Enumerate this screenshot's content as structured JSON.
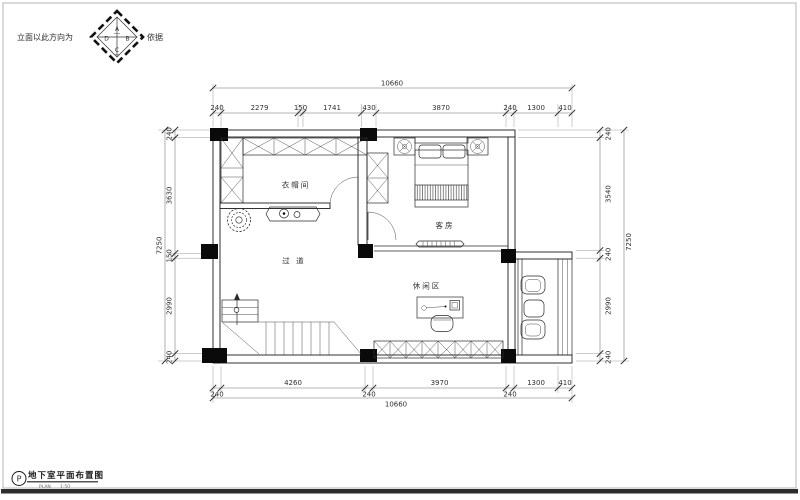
{
  "compass": {
    "left_label": "立面以此方向为",
    "right_label": "依据",
    "sector_top": "A",
    "sector_right": "B",
    "sector_bottom": "C",
    "sector_left": "D"
  },
  "title_block": {
    "badge": "P",
    "title": "地下室平面布置图",
    "sub_left": "PLAN",
    "sub_right": "1:50"
  },
  "rooms": {
    "cloakroom": "衣帽间",
    "guest_room": "客房",
    "corridor": "过 道",
    "leisure": "休闲区"
  },
  "dimensions": {
    "top": {
      "total": "10660",
      "chain": [
        "240",
        "2279",
        "150",
        "1741",
        "430",
        "3870",
        "240",
        "1300",
        "410"
      ]
    },
    "bottom": {
      "total": "10660",
      "chain": [
        "240",
        "4260",
        "240",
        "3970",
        "240",
        "1300",
        "410"
      ]
    },
    "left": {
      "total": "7250",
      "chain": [
        "240",
        "3630",
        "150",
        "2990",
        "240"
      ]
    },
    "right": {
      "total": "7250",
      "chain": [
        "240",
        "3540",
        "240",
        "2990",
        "240"
      ]
    }
  },
  "colors": {
    "background": "#ffffff",
    "line": "#1b1b1b",
    "column_fill": "#0a0a0a"
  }
}
